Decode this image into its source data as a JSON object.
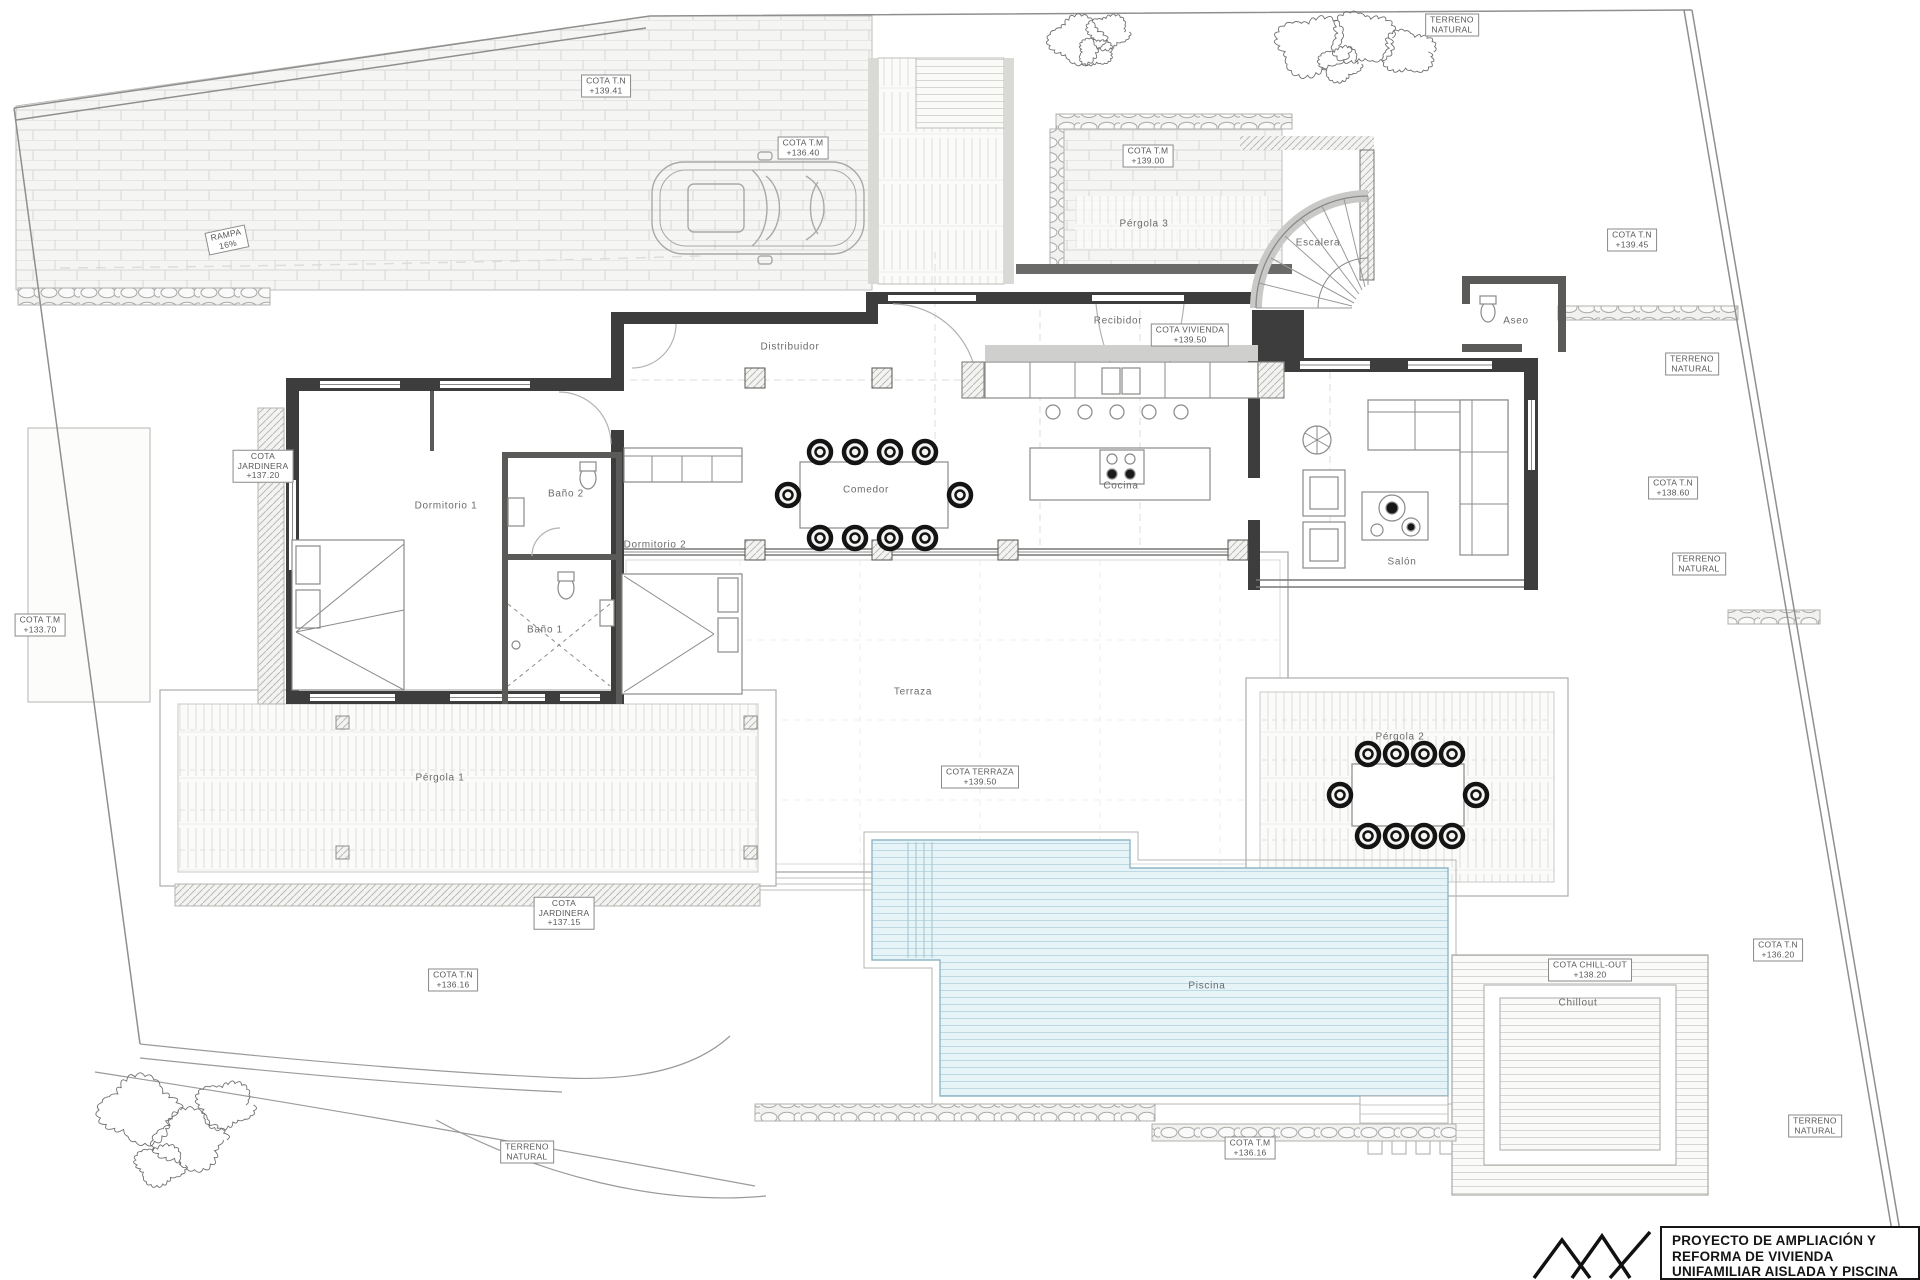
{
  "title_block": {
    "line1": "PROYECTO DE AMPLIACIÓN Y",
    "line2": "REFORMA DE VIVIENDA",
    "line3": "UNIFAMILIAR AISLADA Y PISCINA"
  },
  "colors": {
    "pool_water": "#e6f3f7",
    "pool_stripe": "#bcd9e4",
    "wall_dark": "#3d3d3d",
    "linework": "#8f8f8f",
    "label_text": "#5f5f5f"
  },
  "rooms": [
    {
      "name": "dormitorio-1",
      "label": "Dormitorio 1",
      "x": 446,
      "y": 506
    },
    {
      "name": "bano-2",
      "label": "Baño 2",
      "x": 566,
      "y": 494
    },
    {
      "name": "bano-1",
      "label": "Baño 1",
      "x": 545,
      "y": 630
    },
    {
      "name": "dormitorio-2",
      "label": "Dormitorio 2",
      "x": 655,
      "y": 545
    },
    {
      "name": "distribuidor",
      "label": "Distribuidor",
      "x": 790,
      "y": 347
    },
    {
      "name": "comedor",
      "label": "Comedor",
      "x": 866,
      "y": 490
    },
    {
      "name": "cocina",
      "label": "Cocina",
      "x": 1121,
      "y": 486
    },
    {
      "name": "salon",
      "label": "Salón",
      "x": 1402,
      "y": 562
    },
    {
      "name": "recibidor",
      "label": "Recibidor",
      "x": 1118,
      "y": 321
    },
    {
      "name": "escalera",
      "label": "Escalera",
      "x": 1318,
      "y": 243
    },
    {
      "name": "aseo",
      "label": "Aseo",
      "x": 1516,
      "y": 321
    },
    {
      "name": "pergola-3",
      "label": "Pérgola 3",
      "x": 1144,
      "y": 224
    },
    {
      "name": "pergola-1",
      "label": "Pérgola 1",
      "x": 440,
      "y": 778
    },
    {
      "name": "pergola-2",
      "label": "Pérgola 2",
      "x": 1400,
      "y": 737
    },
    {
      "name": "terraza",
      "label": "Terraza",
      "x": 913,
      "y": 692
    },
    {
      "name": "piscina",
      "label": "Piscina",
      "x": 1207,
      "y": 986
    },
    {
      "name": "chillout",
      "label": "Chillout",
      "x": 1578,
      "y": 1003
    }
  ],
  "cotas": [
    {
      "name": "cota-tn-139-41",
      "lines": [
        "COTA T.N",
        "+139.41"
      ],
      "x": 606,
      "y": 86
    },
    {
      "name": "rampa-16",
      "lines": [
        "RAMPA",
        "16%"
      ],
      "x": 227,
      "y": 240,
      "rot": -12
    },
    {
      "name": "cota-tm-136-40",
      "lines": [
        "COTA T.M",
        "+136.40"
      ],
      "x": 803,
      "y": 148
    },
    {
      "name": "cota-tm-139-00",
      "lines": [
        "COTA T.M",
        "+139.00"
      ],
      "x": 1148,
      "y": 156
    },
    {
      "name": "terreno-nat-1",
      "lines": [
        "TERRENO",
        "NATURAL"
      ],
      "x": 1452,
      "y": 25
    },
    {
      "name": "cota-tn-139-45",
      "lines": [
        "COTA T.N",
        "+139.45"
      ],
      "x": 1632,
      "y": 240
    },
    {
      "name": "terreno-nat-2",
      "lines": [
        "TERRENO",
        "NATURAL"
      ],
      "x": 1692,
      "y": 364
    },
    {
      "name": "cota-jard-137-20",
      "lines": [
        "COTA",
        "JARDINERA",
        "+137.20"
      ],
      "x": 263,
      "y": 466
    },
    {
      "name": "cota-tm-133-70",
      "lines": [
        "COTA T.M",
        "+133.70"
      ],
      "x": 40,
      "y": 625
    },
    {
      "name": "cota-viv-139-50",
      "lines": [
        "COTA VIVIENDA",
        "+139.50"
      ],
      "x": 1190,
      "y": 335
    },
    {
      "name": "cota-tn-138-60",
      "lines": [
        "COTA T.N",
        "+138.60"
      ],
      "x": 1673,
      "y": 488
    },
    {
      "name": "terreno-nat-3",
      "lines": [
        "TERRENO",
        "NATURAL"
      ],
      "x": 1699,
      "y": 564
    },
    {
      "name": "cota-terr-139-50",
      "lines": [
        "COTA TERRAZA",
        "+139.50"
      ],
      "x": 980,
      "y": 777
    },
    {
      "name": "cota-jard-137-15",
      "lines": [
        "COTA",
        "JARDINERA",
        "+137.15"
      ],
      "x": 564,
      "y": 913
    },
    {
      "name": "cota-tn-136-16a",
      "lines": [
        "COTA T.N",
        "+136.16"
      ],
      "x": 453,
      "y": 980
    },
    {
      "name": "terreno-nat-4",
      "lines": [
        "TERRENO",
        "NATURAL"
      ],
      "x": 527,
      "y": 1152
    },
    {
      "name": "cota-tn-136-20",
      "lines": [
        "COTA T.N",
        "+136.20"
      ],
      "x": 1778,
      "y": 950
    },
    {
      "name": "cota-chillout",
      "lines": [
        "COTA CHILL-OUT",
        "+138.20"
      ],
      "x": 1590,
      "y": 970
    },
    {
      "name": "terreno-nat-5",
      "lines": [
        "TERRENO",
        "NATURAL"
      ],
      "x": 1815,
      "y": 1126
    },
    {
      "name": "cota-tm-136-16b",
      "lines": [
        "COTA T.M",
        "+136.16"
      ],
      "x": 1250,
      "y": 1148
    }
  ]
}
